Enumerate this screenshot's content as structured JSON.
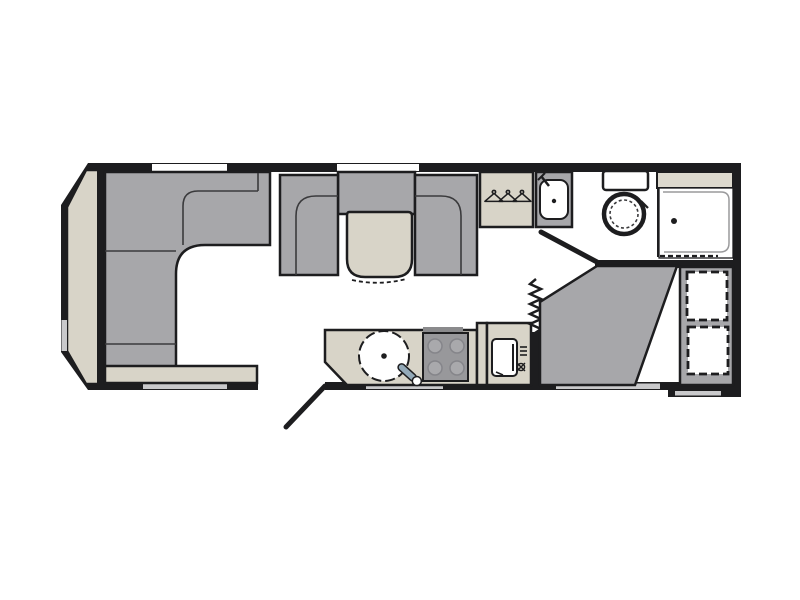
{
  "page": {
    "kind": "caravan-floorplan-drawing",
    "background": "#ffffff"
  },
  "colors": {
    "wall": "#1d1d1f",
    "floor": "#ffffff",
    "upholstery": "#a7a7aa",
    "surface": "#d8d4c8",
    "surface_light": "#ddd9ce",
    "hob": "#98989b",
    "hob_burner": "#a9a9ac",
    "window": "#c9c9cb",
    "tap": "#93a9b8",
    "seam": "#3a3a3c"
  },
  "icons": {
    "hanger_icon": "clothes-hanger",
    "sink_icon": "round-sink-with-tap",
    "hob_icon": "four-burner-hob",
    "fridge_icon": "refrigerator",
    "basin_icon": "washbasin-with-tap",
    "toilet_icon": "toilet-with-cistern",
    "shower_icon": "shower-tray-with-drain",
    "bed_icon": "corner-double-bed",
    "bunk_icon": "bunk-bed-dashed-outline",
    "door_swing_icon": "open-door-swing",
    "concertina_door_icon": "folding-partition-door",
    "window_icon": "window-opening"
  }
}
